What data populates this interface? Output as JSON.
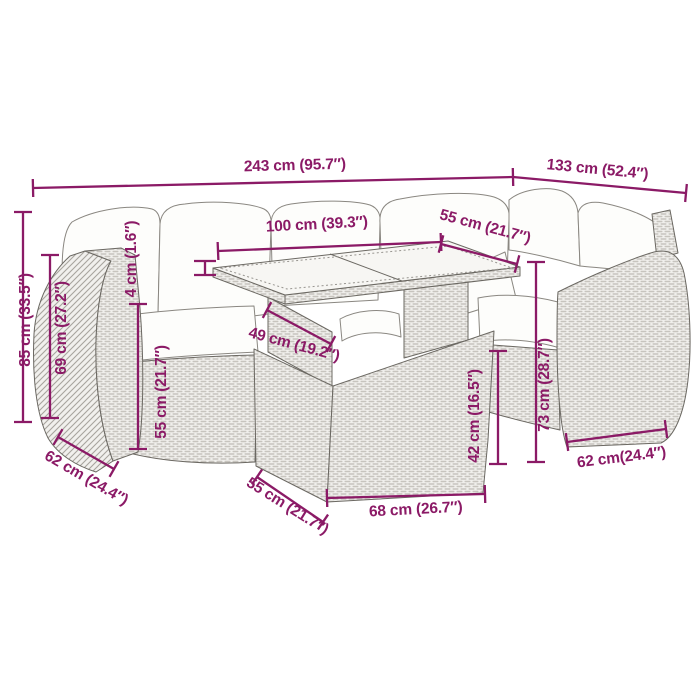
{
  "style": {
    "dimension_color": "#8B1A66",
    "line_color": "#6b6862",
    "background": "#ffffff"
  },
  "dims": {
    "overall_width": "243 cm (95.7″)",
    "right_section_width": "133 cm (52.4″)",
    "table_length": "100 cm (39.3″)",
    "table_width": "55 cm (21.7″)",
    "glass_thickness": "4 cm (1.6″)",
    "total_height": "85 cm (33.5″)",
    "armrest_height": "69 cm (27.2″)",
    "left_seat_depth": "62 cm (24.4″)",
    "seat_height": "55 cm (21.7″)",
    "under_table_depth": "49 cm (19.2″)",
    "table_base_height": "42 cm (16.5″)",
    "right_back_height": "73 cm (28.7″)",
    "table_base_depth": "55 cm (21.7″)",
    "table_base_length": "68 cm (26.7″)",
    "right_seat_depth": "62 cm(24.4″)"
  }
}
